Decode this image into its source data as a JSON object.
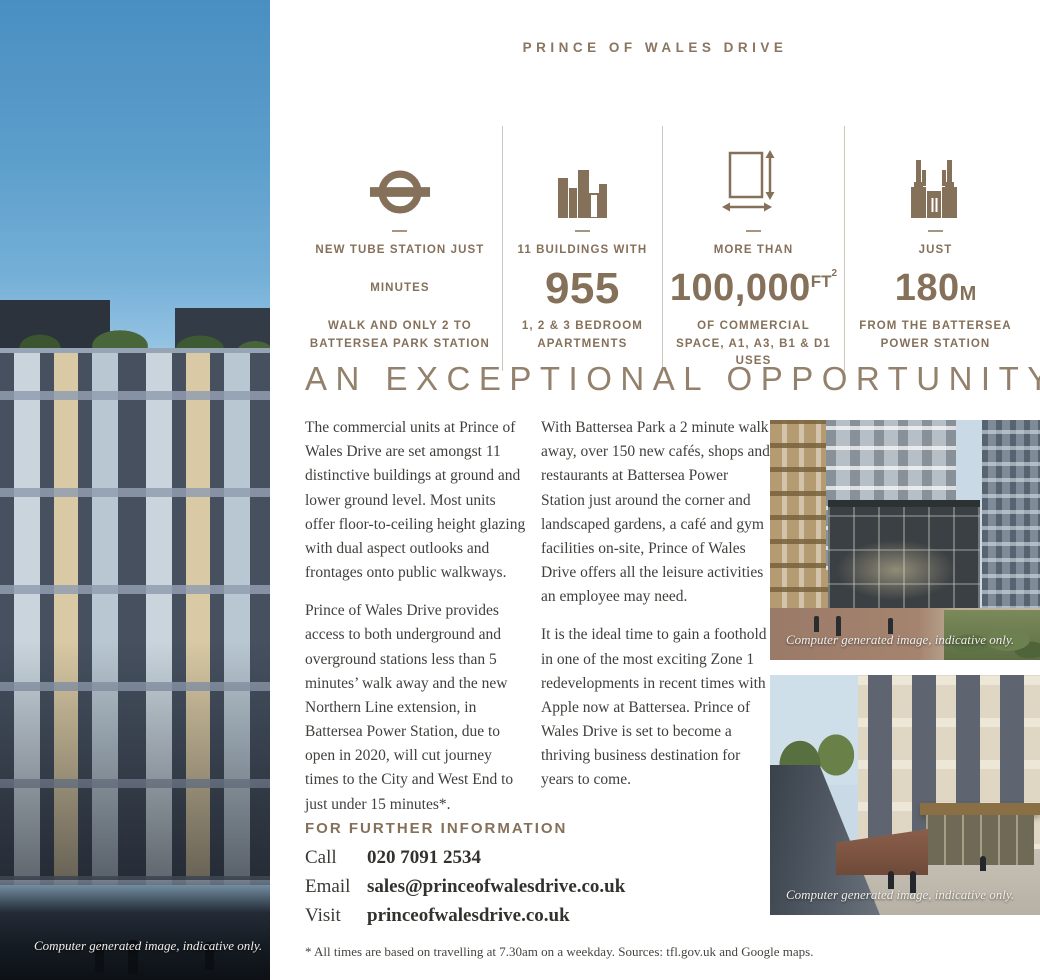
{
  "page": {
    "title": "PRINCE OF WALES DRIVE"
  },
  "left_photo": {
    "caption": "Computer generated image, indicative only."
  },
  "stats": [
    {
      "icon": "tube-roundel-icon",
      "line1": "NEW TUBE STATION JUST",
      "line2": "MINUTES",
      "line3": "WALK AND ONLY 2 TO BATTERSEA PARK STATION"
    },
    {
      "icon": "buildings-icon",
      "line1": "11 BUILDINGS WITH",
      "value": "955",
      "line3": "1, 2 & 3 BEDROOM APARTMENTS"
    },
    {
      "icon": "floorplan-measure-icon",
      "line1": "MORE THAN",
      "value": "100,000",
      "unit": "FT",
      "unit_sup": "2",
      "line3": "OF COMMERCIAL SPACE, A1, A3, B1 & D1 USES"
    },
    {
      "icon": "power-station-icon",
      "line1": "JUST",
      "value": "180",
      "unit": "M",
      "line3": "FROM THE BATTERSEA POWER STATION"
    }
  ],
  "headline": "AN EXCEPTIONAL OPPORTUNITY",
  "body": {
    "col1_p1": "The commercial units at Prince of Wales Drive are set amongst 11 distinctive buildings at ground and lower ground level. Most units offer floor-to-ceiling height glazing with dual aspect outlooks and frontages onto public walkways.",
    "col1_p2": "Prince of Wales Drive provides access to both underground and overground stations less than 5 minutes’ walk away and the new Northern Line extension, in Battersea Power Station, due to open in 2020, will cut journey times to the City and West End to just under 15 minutes*.",
    "col2_p1": "With Battersea Park a 2 minute walk away, over 150 new cafés, shops and restaurants at Battersea Power Station just around the corner and landscaped gardens, a café and gym facilities on-site, Prince of Wales Drive offers all the leisure activities an employee may need.",
    "col2_p2": "It is the ideal time to gain a foothold in one of the most exciting Zone 1 redevelopments in recent times with Apple now at Battersea. Prince of Wales Drive is set to become a thriving business destination for years to come."
  },
  "photos": [
    {
      "caption": "Computer generated image, indicative only."
    },
    {
      "caption": "Computer generated image, indicative only."
    }
  ],
  "contact": {
    "heading": "FOR FURTHER INFORMATION",
    "rows": [
      {
        "label": "Call",
        "value": "020 7091 2534"
      },
      {
        "label": "Email",
        "value": "sales@princeofwalesdrive.co.uk"
      },
      {
        "label": "Visit",
        "value": "princeofwalesdrive.co.uk"
      }
    ]
  },
  "footnote": "* All times are based on travelling at 7.30am on a weekday. Sources: tfl.gov.uk and Google maps.",
  "colors": {
    "accent": "#85705A",
    "headline": "#93816C",
    "body_text": "#403F3C"
  }
}
